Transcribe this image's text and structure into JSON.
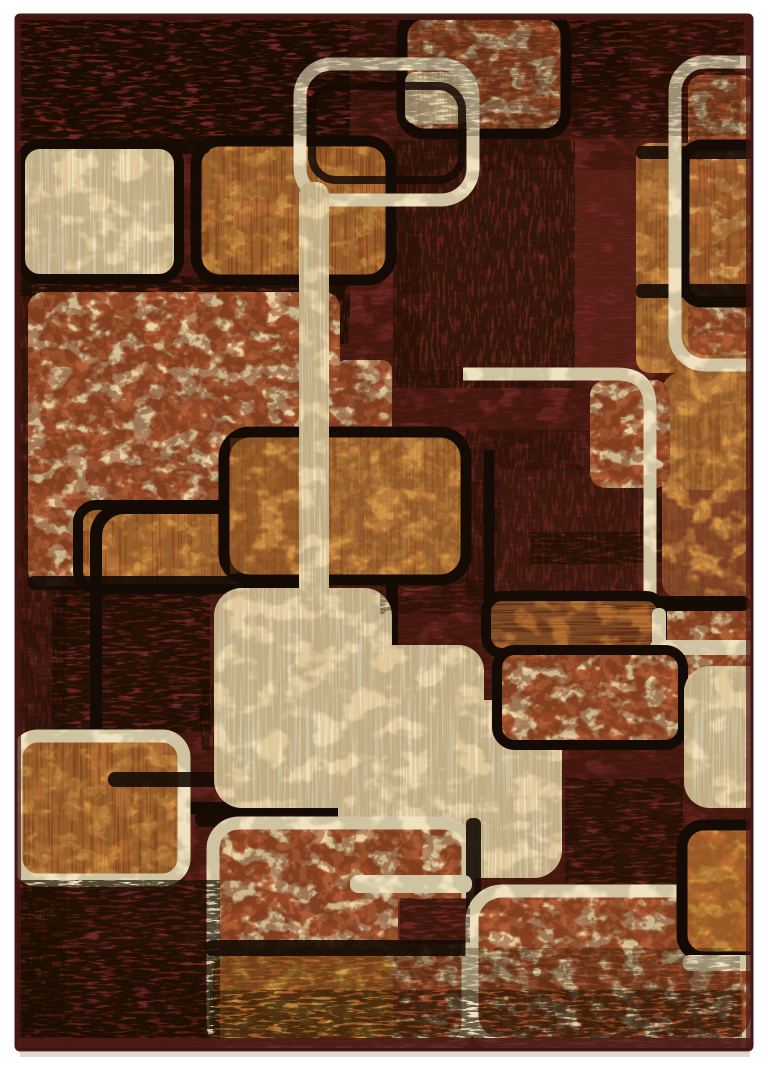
{
  "image": {
    "description": "Product photo of a retro modern area rug with overlapping rounded squares in cream, caramel and brick-tan on a mottled dark maroon ground",
    "width": 768,
    "height": 1068
  },
  "palette": {
    "bg": "#FFFFFF",
    "maroon": "#6E2722",
    "maroon_dark": "#451510",
    "black": "#150B06",
    "cream": "#F0E2BE",
    "cream_shade": "#C7A468",
    "brick_base": "#E9D2A4",
    "brick_line": "#A34A22",
    "brick_dark": "#7A2D14",
    "caramel": "#C98A3C",
    "caramel_hi": "#E2A95A",
    "burnt": "#9A5524",
    "gold": "#D79B43",
    "rug_edge": "#471713",
    "shadow": "#D8D4CA"
  },
  "rug": {
    "x": 14,
    "y": 13,
    "w": 740,
    "h": 1039,
    "inner_x": 16,
    "inner_y": 15,
    "inner_w": 736,
    "inner_h": 1035
  },
  "highlights": [
    [
      420,
      170,
      240,
      200,
      0.3
    ],
    [
      500,
      470,
      150,
      120,
      0.28
    ]
  ],
  "underGrunge": [
    [
      20,
      16,
      330,
      130,
      0.8,
      "g"
    ],
    [
      340,
      16,
      290,
      75,
      0.45,
      "g"
    ],
    [
      14,
      150,
      52,
      880,
      0.45,
      "gv"
    ],
    [
      52,
      585,
      158,
      148,
      0.72,
      "g"
    ],
    [
      393,
      140,
      182,
      248,
      0.55,
      "gv"
    ],
    [
      572,
      18,
      172,
      120,
      0.45,
      "g"
    ],
    [
      16,
      276,
      308,
      20,
      0.72,
      "g"
    ],
    [
      530,
      532,
      142,
      32,
      0.55,
      "g"
    ],
    [
      326,
      196,
      24,
      148,
      0.78,
      "gv"
    ],
    [
      466,
      430,
      172,
      168,
      0.42,
      "gv"
    ],
    [
      640,
      482,
      32,
      60,
      0.6,
      "gv"
    ],
    [
      565,
      778,
      118,
      108,
      0.6,
      "g"
    ],
    [
      398,
      896,
      72,
      48,
      0.5,
      "g"
    ],
    [
      200,
      685,
      16,
      65,
      0.6,
      "gv"
    ]
  ],
  "shapes": [
    [
      "rect",
      "brick-field-left",
      28,
      292,
      312,
      294,
      16,
      "brick",
      null,
      0,
      1
    ],
    [
      "rect",
      "brick-field-ext",
      336,
      360,
      56,
      152,
      10,
      "brick",
      null,
      0,
      0.95
    ],
    [
      "rect",
      "caramel-inset-left",
      78,
      505,
      234,
      84,
      18,
      "brickC",
      "black",
      10,
      1
    ],
    [
      "rect",
      "black-outline-loop",
      96,
      508,
      296,
      300,
      28,
      null,
      "black",
      12,
      1
    ],
    [
      "bar",
      "black-band-field-bottom",
      28,
      576,
      288,
      14,
      6,
      "black",
      0.92
    ],
    [
      "rect",
      "cream-square-topleft",
      20,
      144,
      159,
      135,
      20,
      "cream",
      "black",
      10,
      1
    ],
    [
      "rect",
      "caramel-square-top",
      196,
      141,
      195,
      139,
      24,
      "brickC",
      "black",
      11,
      1
    ],
    [
      "bar",
      "black-gap-top",
      170,
      139,
      40,
      15,
      6,
      "black",
      0.9
    ],
    [
      "rect",
      "brick-square-topcenter",
      402,
      14,
      164,
      120,
      22,
      "brick",
      "black",
      11,
      1
    ],
    [
      "rect",
      "cream-block-inner",
      405,
      72,
      64,
      52,
      10,
      "cream",
      null,
      0,
      1
    ],
    [
      "rect",
      "black-offset-outline-top",
      312,
      86,
      150,
      94,
      24,
      null,
      "black",
      8,
      0.85
    ],
    [
      "rect",
      "cream-outline-topcenter",
      300,
      64,
      173,
      136,
      32,
      null,
      "cream",
      13,
      1
    ],
    [
      "rect",
      "caramel-column-right",
      636,
      143,
      120,
      230,
      14,
      "caramel",
      null,
      0,
      0.95
    ],
    [
      "rect",
      "brick-inner-right",
      688,
      75,
      67,
      280,
      14,
      "brick",
      null,
      0,
      1
    ],
    [
      "rect",
      "caramel-overlay-right",
      688,
      160,
      67,
      125,
      8,
      "brickC",
      null,
      0,
      0.8
    ],
    [
      "bar",
      "black-band-right-1",
      636,
      146,
      119,
      13,
      5,
      "black",
      0.9
    ],
    [
      "bar",
      "black-band-right-2",
      636,
      284,
      119,
      14,
      5,
      "black",
      0.9
    ],
    [
      "rect",
      "black-outline-right",
      684,
      145,
      140,
      157,
      18,
      null,
      "black",
      11,
      1
    ],
    [
      "rect",
      "cream-outline-right",
      675,
      62,
      148,
      303,
      30,
      null,
      "cream",
      13,
      1
    ],
    [
      "rect",
      "caramel-panel-right",
      662,
      372,
      106,
      228,
      20,
      "caramel",
      null,
      0,
      1
    ],
    [
      "tint",
      "maroon-fade-right",
      662,
      490,
      106,
      110,
      0,
      "maroon",
      0.45
    ],
    [
      "rect",
      "caramel-square-center",
      224,
      432,
      242,
      148,
      26,
      "caramel",
      "black",
      11,
      1
    ],
    [
      "tint",
      "dark-overlay-center",
      230,
      438,
      100,
      136,
      0,
      "burnt",
      0.4
    ],
    [
      "rect",
      "brick-patch-center",
      590,
      380,
      80,
      108,
      16,
      "brick",
      null,
      0,
      1
    ],
    [
      "path",
      "black-corner-center",
      "M489,450 L489,594 Q489,622 517,622 L625,622",
      "black",
      11
    ],
    [
      "path",
      "cream-outline-center",
      "M463,374 L617,374 Q650,374 650,407 L650,608 Q650,641 617,641 L586,641",
      "cream",
      13
    ],
    [
      "rect",
      "cream-bar-vertical",
      299,
      182,
      30,
      430,
      13,
      "cream",
      null,
      0,
      1
    ],
    [
      "rect",
      "caramel-panel-bottomleft",
      16,
      736,
      168,
      144,
      22,
      "brickC",
      "cream",
      13,
      1
    ],
    [
      "bar",
      "black-line-bottomleft",
      108,
      772,
      230,
      15,
      7,
      "black",
      0.9
    ],
    [
      "rect",
      "cream-blob-1",
      214,
      588,
      178,
      220,
      28,
      "cream",
      null,
      0,
      1
    ],
    [
      "bar",
      "black-band-blob",
      195,
      810,
      200,
      17,
      8,
      "black",
      0.92
    ],
    [
      "rect",
      "cream-blob-2",
      318,
      645,
      166,
      150,
      26,
      "cream",
      null,
      0,
      1
    ],
    [
      "rect",
      "cream-blob-3",
      338,
      700,
      224,
      178,
      28,
      "cream",
      null,
      0,
      1
    ],
    [
      "rect",
      "brick-strip-right",
      660,
      598,
      94,
      140,
      12,
      "brick",
      null,
      0,
      1
    ],
    [
      "bar",
      "black-topbar-mid",
      486,
      596,
      264,
      15,
      7,
      "black",
      1
    ],
    [
      "rect",
      "burnt-rect-mid",
      486,
      596,
      176,
      57,
      16,
      "burnt",
      "black",
      10,
      1
    ],
    [
      "bar",
      "cream-corner-v",
      652,
      608,
      14,
      44,
      6,
      "cream",
      1
    ],
    [
      "bar",
      "cream-corner-h",
      650,
      640,
      104,
      15,
      7,
      "cream",
      1
    ],
    [
      "rect",
      "brick-panel-mid",
      497,
      650,
      186,
      95,
      18,
      "brick",
      "black",
      10,
      1
    ],
    [
      "rect",
      "cream-panel-right",
      684,
      666,
      110,
      142,
      26,
      "cream",
      null,
      0,
      1
    ],
    [
      "rect",
      "brick-panel-bottomleft",
      213,
      823,
      255,
      226,
      26,
      "brick",
      "cream",
      13,
      1
    ],
    [
      "bar",
      "maroon-notch",
      398,
      899,
      72,
      44,
      6,
      "maroon",
      1
    ],
    [
      "bar",
      "black-bar-v2",
      466,
      818,
      15,
      134,
      6,
      "black",
      0.9
    ],
    [
      "bar",
      "black-bar-h2",
      205,
      940,
      272,
      16,
      7,
      "black",
      0.9
    ],
    [
      "rect",
      "gold-inset-bottomleft",
      213,
      956,
      180,
      90,
      14,
      "gold",
      null,
      0,
      0.95
    ],
    [
      "bar",
      "cream-band-mid",
      350,
      875,
      122,
      18,
      8,
      "cream",
      1
    ],
    [
      "rect",
      "brick-panel-bottom",
      472,
      891,
      285,
      154,
      30,
      "brick",
      "cream",
      13,
      1
    ],
    [
      "rect",
      "gold-square-bottomright",
      682,
      825,
      112,
      132,
      22,
      "gold",
      "black",
      11,
      1
    ],
    [
      "bar",
      "cream-band-bottomright",
      683,
      955,
      73,
      16,
      7,
      "cream",
      1
    ],
    [
      "circle",
      "stitch-ring",
      537,
      972,
      5
    ]
  ],
  "overGrunge": [
    [
      16,
      14,
      724,
      122,
      0.28,
      "g"
    ],
    [
      16,
      948,
      724,
      102,
      0.3,
      "g"
    ],
    [
      14,
      880,
      206,
      168,
      0.68,
      "g"
    ],
    [
      210,
      990,
      532,
      58,
      0.45,
      "g"
    ],
    [
      380,
      578,
      110,
      36,
      0.4,
      "g"
    ],
    [
      400,
      898,
      70,
      46,
      0.5,
      "g"
    ],
    [
      16,
      14,
      738,
      1037,
      0.14,
      "m"
    ]
  ]
}
